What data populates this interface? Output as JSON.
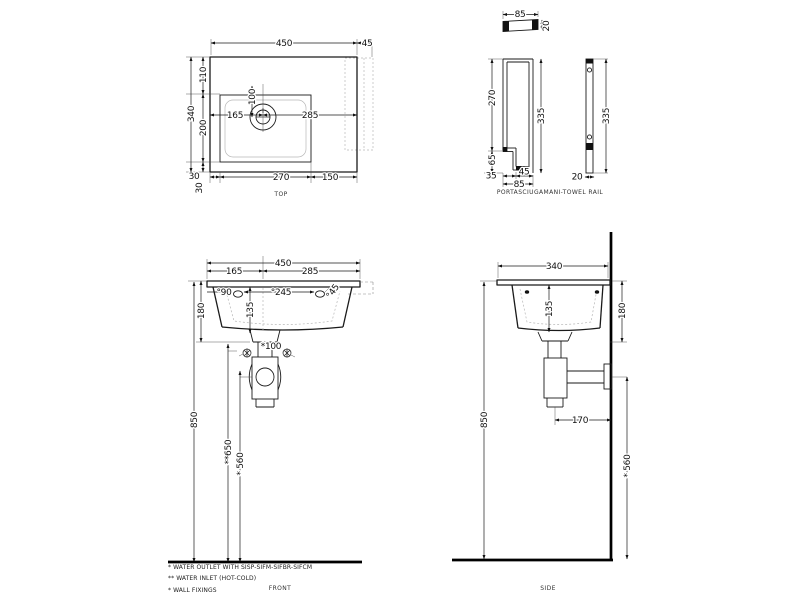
{
  "top_view": {
    "label": "TOP",
    "dim_width_total": "450",
    "dim_rail_overhang": "45",
    "dim_back_to_bowl": "110",
    "dim_bowl_depth": "200",
    "dim_depth_total": "340",
    "dim_bowl_bottom_offset": "30",
    "dim_bowl_left_offset": "30",
    "dim_bowl_width": "270",
    "dim_right_section": "150",
    "dim_tap_from_left": "165",
    "dim_tap_to_right": "285",
    "dim_tap_setback": "100"
  },
  "rail_views": {
    "label": "PORTASCIUGAMANI-TOWEL RAIL",
    "dim_bar_width": "85",
    "dim_bar_thickness": "20",
    "dim_front_leg": "270",
    "dim_foot_height": "65",
    "dim_height_left": "335",
    "dim_foot_offset": "35",
    "dim_foot_width": "45",
    "dim_foot_total": "85",
    "dim_height_right": "335",
    "dim_bar_depth": "20"
  },
  "front_view": {
    "label": "FRONT",
    "dim_width_total": "450",
    "dim_tap_from_left": "165",
    "dim_tap_to_right": "285",
    "dim_hole_left": "°90",
    "dim_hole_spacing": "°245",
    "dim_hole_right": "°45",
    "dim_front_height": "180",
    "dim_bowl_inner_depth": "135",
    "dim_fixing_spacing": "*100",
    "dim_rim_height": "850",
    "dim_inlet_height": "**650",
    "dim_outlet_height": "* 560"
  },
  "side_view": {
    "label": "SIDE",
    "dim_depth_total": "340",
    "dim_bowl_inner_depth": "135",
    "dim_front_height": "180",
    "dim_rim_height": "850",
    "dim_outlet_offset": "170",
    "dim_outlet_height": "* 560"
  },
  "footnotes": [
    "*  WATER OUTLET WITH SISP-SIFM-SIFBR-SIFCM",
    "** WATER INLET  (HOT-COLD)",
    "*  WALL FIXINGS"
  ]
}
